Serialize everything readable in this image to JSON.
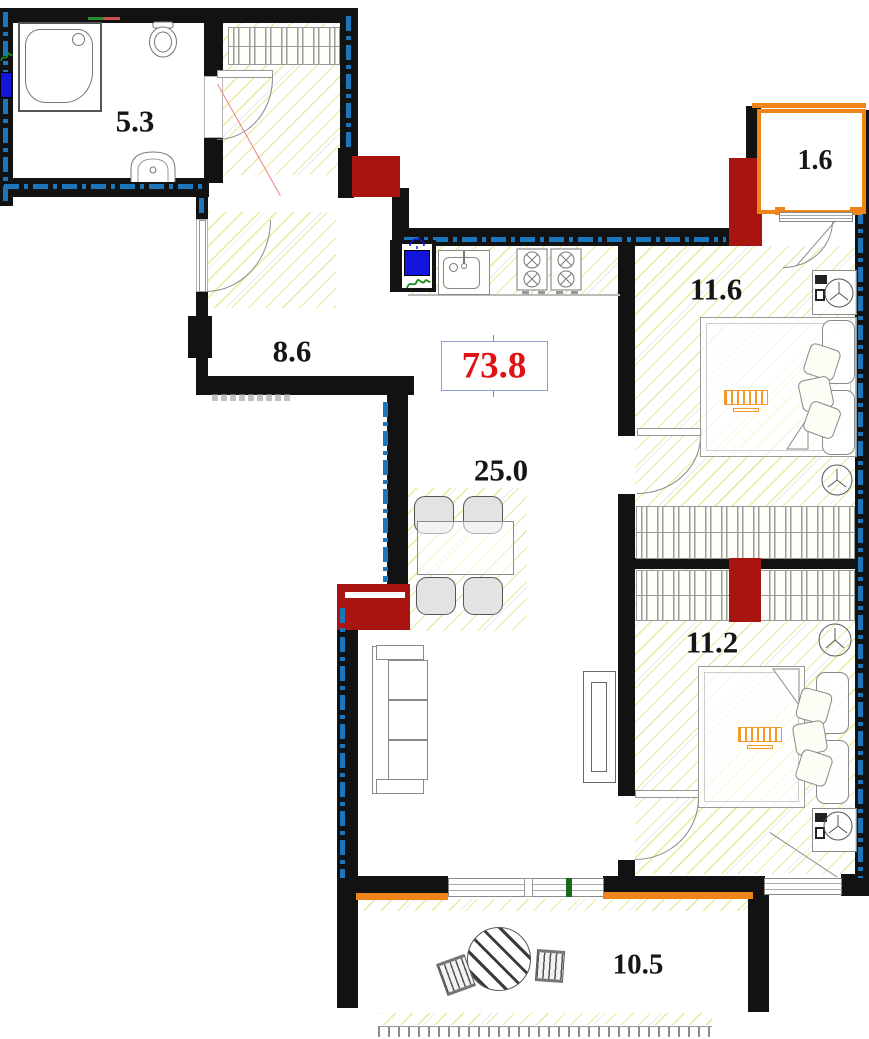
{
  "labels": {
    "total_area": "73.8",
    "bathroom": "5.3",
    "hallway": "8.6",
    "living_kitchen": "25.0",
    "bedroom_top": "11.6",
    "bedroom_bottom": "11.2",
    "balcony": "1.6",
    "terrace": "10.5"
  },
  "colors": {
    "wall": "#121212",
    "vent_red": "#a81410",
    "accent_orange": "#ef8519",
    "insulation_blue": "#1b76bb",
    "appliance_blue": "#1414dd",
    "total_red": "#e01414",
    "window_green": "#176b1c",
    "door_red_line": "#e8837b",
    "hatch_yellow": "#e6e23c"
  }
}
